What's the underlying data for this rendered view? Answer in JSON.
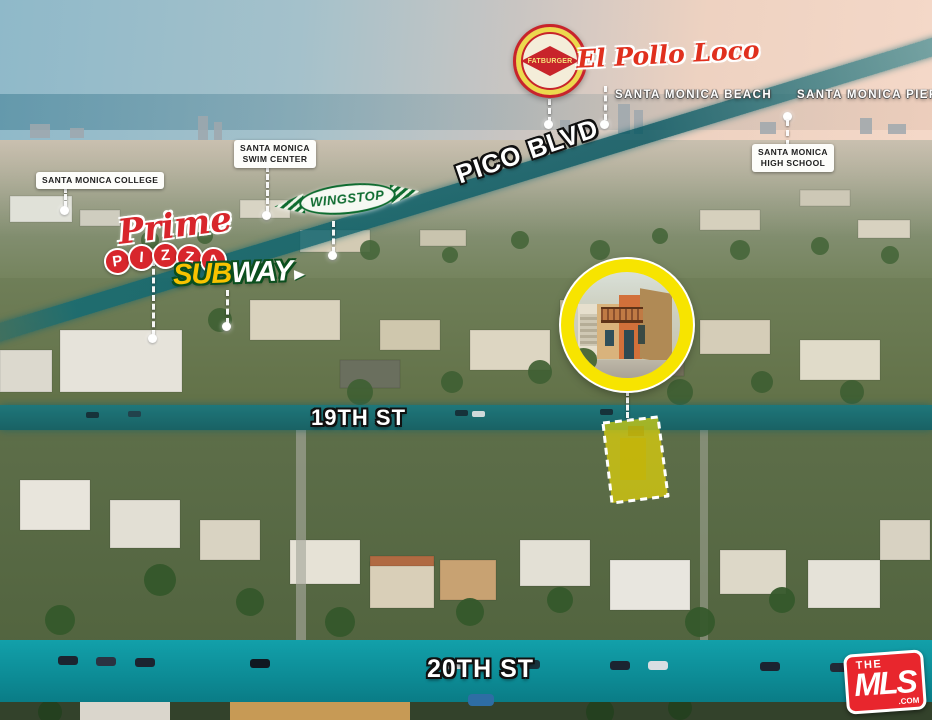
{
  "scene": {
    "type": "aerial-property-location-photo",
    "area": "Santa Monica"
  },
  "colors": {
    "road_highlight": "#0d8a96",
    "property_highlight": "#f7e400",
    "inset_ring": "#f7e400",
    "fatburger_red": "#c8242b",
    "pollo_red": "#e0301e",
    "wingstop_green": "#0d6b2f",
    "subway_yellow": "#f8c300",
    "subway_green": "#0b4f1e",
    "prime_red": "#d8262c",
    "mls_red": "#e8262d",
    "sky_left": "#8fb9c9",
    "sky_right": "#f4d8c8"
  },
  "landmarks": {
    "beach": {
      "label": "SANTA MONICA BEACH"
    },
    "pier": {
      "label": "SANTA MONICA PIER"
    },
    "college": {
      "label": "SANTA MONICA COLLEGE"
    },
    "swim_center": {
      "line1": "SANTA MONICA",
      "line2": "SWIM CENTER"
    },
    "high_school": {
      "line1": "SANTA MONICA",
      "line2": "HIGH SCHOOL"
    }
  },
  "streets": {
    "pico": "PICO BLVD",
    "nineteenth": "19TH ST",
    "twentieth": "20TH ST"
  },
  "brands": {
    "fatburger": "FATBURGER",
    "el_pollo_loco": "El Pollo Loco",
    "wingstop": "WINGSTOP",
    "prime": "Prime",
    "pizza_letters": [
      "P",
      "I",
      "Z",
      "Z",
      "A"
    ],
    "subway_sub": "SUB",
    "subway_way": "WAY",
    "mls_the": "THE",
    "mls_name": "MLS",
    "mls_com": ".COM"
  }
}
